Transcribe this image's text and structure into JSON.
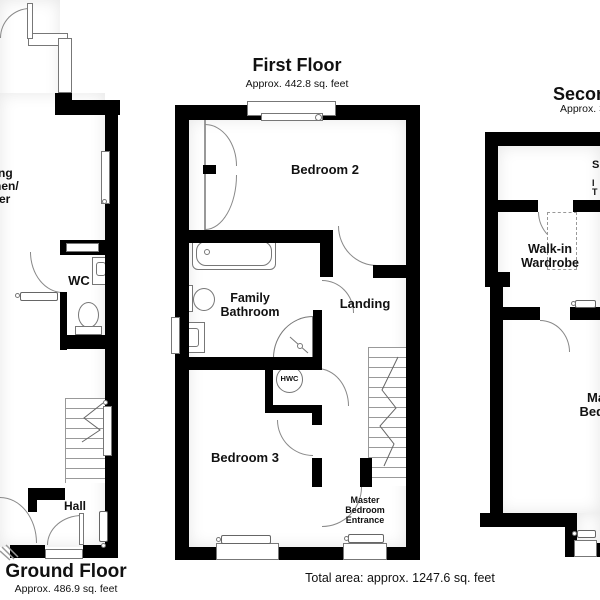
{
  "floors": {
    "ground": {
      "title": "Ground Floor",
      "subtitle": "Approx. 486.9 sq. feet",
      "rooms": {
        "living_kitchen_diner": {
          "line1": "Living",
          "line2": "Kitchen/",
          "line3": "Diner"
        },
        "wc": "WC",
        "hall": "Hall"
      }
    },
    "first": {
      "title": "First Floor",
      "subtitle": "Approx. 442.8 sq. feet",
      "rooms": {
        "bedroom2": "Bedroom 2",
        "family_bathroom": {
          "line1": "Family",
          "line2": "Bathroom"
        },
        "landing": "Landing",
        "hwc": "HWC",
        "bedroom3": "Bedroom 3",
        "master_entrance": {
          "line1": "Master",
          "line2": "Bedroom",
          "line3": "Entrance"
        }
      }
    },
    "second": {
      "title": "Second Floor",
      "subtitle": "Approx. 317.9 sq. feet",
      "rooms": {
        "walk_in_wardrobe": {
          "line1": "Walk-in",
          "line2": "Wardrobe"
        },
        "master_bedroom": {
          "line1": "Master",
          "line2": "Bedroom"
        },
        "edge_fragments": {
          "a": "S",
          "b": "I",
          "c": "T"
        }
      }
    }
  },
  "footer": {
    "total_area": "Total area: approx. 1247.6 sq. feet"
  },
  "colors": {
    "wall": "#000000",
    "fixture_outline": "#777777",
    "text": "#111111",
    "background": "#ffffff"
  }
}
